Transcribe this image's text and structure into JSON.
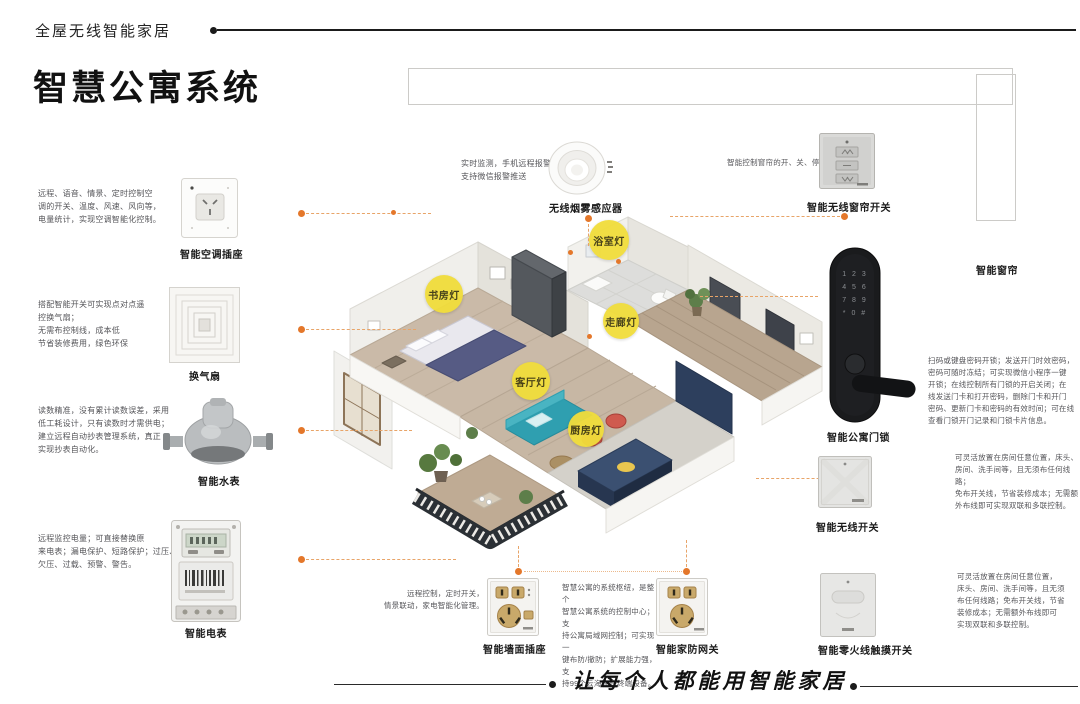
{
  "page": {
    "tagline": "全屋无线智能家居",
    "title": "智慧公寓系统",
    "slogan": "让每个人都能用智能家居"
  },
  "colors": {
    "accent_orange": "#e4772a",
    "light_yellow": "#f1dd3b",
    "lock_black": "#1a1b1d",
    "socket_gold": "#c9a96a"
  },
  "lights": [
    {
      "label": "书房灯"
    },
    {
      "label": "浴室灯"
    },
    {
      "label": "走廊灯"
    },
    {
      "label": "客厅灯"
    },
    {
      "label": "厨房灯"
    }
  ],
  "devices": [
    {
      "id": "ac-socket",
      "name": "智能空调插座",
      "desc": "远程、语音、情景、定时控制空\n调的开关、温度、风速、风向等，\n电量统计，实现空调智能化控制。"
    },
    {
      "id": "vent-fan",
      "name": "换气扇",
      "desc": "搭配智能开关可实现点对点遥\n控换气扇；\n无需布控制线，成本低\n节省装修费用，绿色环保"
    },
    {
      "id": "water-meter",
      "name": "智能水表",
      "desc": "读数精准，没有累计读数误差，采用\n低工耗设计，只有读数时才需供电；\n建立远程自动抄表管理系统，真正\n实现抄表自动化。"
    },
    {
      "id": "electric-meter",
      "name": "智能电表",
      "desc": "远程监控电量；可直接替换原\n来电表；漏电保护、短路保护；过压、\n欠压、过载、预警、警告。"
    },
    {
      "id": "smoke-sensor",
      "name": "无线烟雾感应器",
      "desc": "实时监测，手机远程报警推送，\n支持微信报警推送"
    },
    {
      "id": "curtain-switch",
      "name": "智能无线窗帘开关",
      "desc": "智能控制窗帘的开、关、停"
    },
    {
      "id": "curtain",
      "name": "智能窗帘",
      "desc": ""
    },
    {
      "id": "door-lock",
      "name": "智能公寓门锁",
      "desc": "扫码或键盘密码开锁；发送开门时效密码，\n密码可随时冻结；可实现微信小程序一键\n开锁；在线控制所有门锁的开启关闭；在\n线发送门卡和打开密码，删除门卡和开门\n密码、更新门卡和密码的有效时间；可在线\n查看门锁开门记录和门锁卡片信息。",
      "keypad": "1 2 3\n4 5 6\n7 8 9\n* 0 #"
    },
    {
      "id": "wireless-switch",
      "name": "智能无线开关",
      "desc": "可灵活放置在房间任意位置，床头、\n房间、洗手间等，且无须布任何线路；\n免布开关线，节省装修成本；无需额\n外布线即可实现双联和多联控制。"
    },
    {
      "id": "touch-switch",
      "name": "智能零火线触摸开关",
      "desc": "可灵活放置在房间任意位置，\n床头、房间、洗手间等，且无须\n布任何线路；免布开关线，节省\n装修成本；无需额外布线即可\n实现双联和多联控制。"
    },
    {
      "id": "wall-socket",
      "name": "智能墙面插座",
      "desc": "远程控制，定时开关，\n情景联动，家电智能化管理。"
    },
    {
      "id": "gateway",
      "name": "智能家防网关",
      "desc": "智慧公寓的系统枢纽，是整个\n智慧公寓系统的控制中心；支\n持公寓局域网控制；可实现一\n键布防/撤防；扩展能力强，支\n持99个云海物联终端设备。"
    }
  ]
}
